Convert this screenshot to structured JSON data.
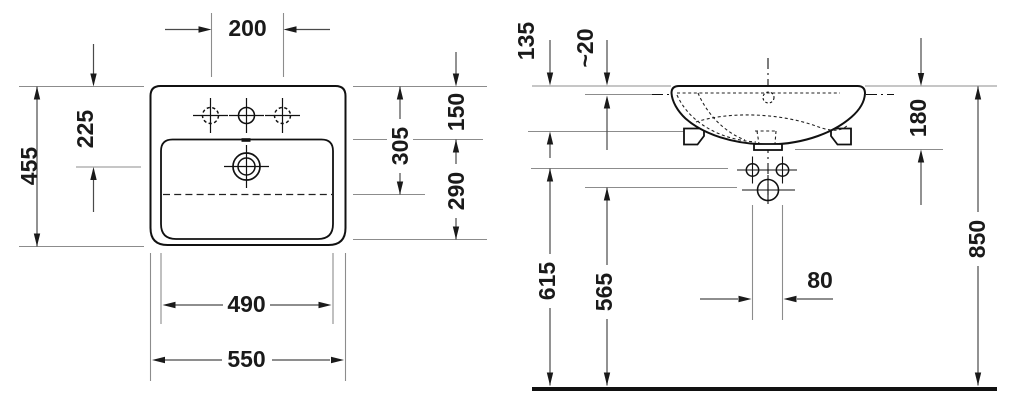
{
  "front_view": {
    "dimensions": {
      "tap_hole_spacing": "200",
      "overall_depth": "455",
      "rim_to_overflow": "225",
      "bowl_length": "305",
      "rim_to_bowl_back": "150",
      "bowl_back_to_front": "290",
      "bowl_width": "490",
      "overall_width": "550"
    }
  },
  "side_view": {
    "dimensions": {
      "body_height": "135",
      "rim_thickness": "~20",
      "rim_to_outlet": "180",
      "floor_to_rim": "850",
      "floor_to_fixing_holes": "615",
      "floor_to_outlet": "565",
      "fixing_hole_spacing": "80"
    }
  }
}
